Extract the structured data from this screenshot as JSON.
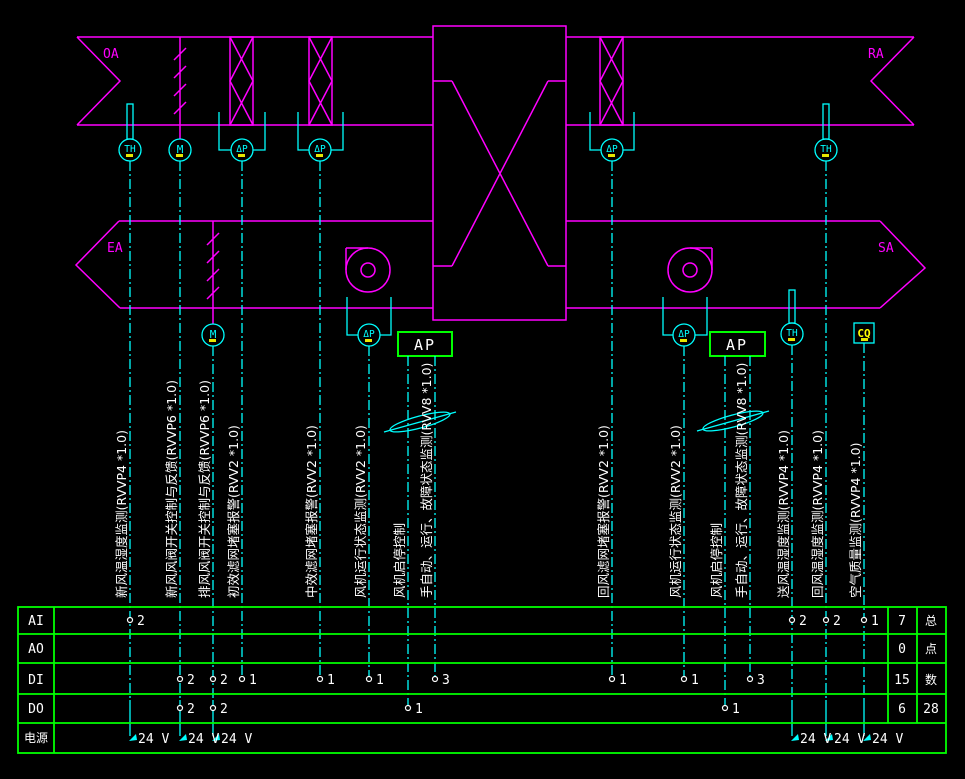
{
  "colors": {
    "duct_line": "#ff00ff",
    "signal_line": "#00ffff",
    "table_line": "#00ff00",
    "text": "#ffffff",
    "tag_text": "#ffff00",
    "background": "#000000"
  },
  "duct_labels": {
    "oa": "OA",
    "ra": "RA",
    "ea": "EA",
    "sa": "SA"
  },
  "symbols": {
    "temp_humidity": "TH",
    "damper_actuator": "M",
    "diff_pressure": "ΔP",
    "controller": "AP",
    "air_quality": "CQ"
  },
  "cables": [
    "新风温湿度监测(RVVP4 *1.0)",
    "新风风阀开关控制与反馈(RVVP6 *1.0)",
    "排风风阀开关控制与反馈(RVVP6 *1.0)",
    "初效滤网堵塞报警(RVV2 *1.0)",
    "中效滤网堵塞报警(RVV2 *1.0)",
    "风机运行状态监测(RVV2 *1.0)",
    "风机启停控制",
    "手自动、运行、故障状态监测(RVV8 *1.0)",
    "回风滤网堵塞报警(RVV2 *1.0)",
    "风机运行状态监测(RVV2 *1.0)",
    "风机启停控制",
    "手自动、运行、故障状态监测(RVV8 *1.0)",
    "送风温湿度监测(RVVP4 *1.0)",
    "回风温湿度监测(RVVP4 *1.0)",
    "空气质量监测(RVVP4 *1.0)"
  ],
  "table": {
    "row_labels": [
      "AI",
      "AO",
      "DI",
      "DO",
      "电源"
    ],
    "totals": [
      "7",
      "0",
      "15",
      "6"
    ],
    "totals_header_chars": [
      "总",
      "点",
      "数"
    ],
    "grand_total": "28",
    "power_value": "24 V",
    "ai_counts": [
      "2",
      "2",
      "2",
      "1"
    ],
    "di_counts": [
      "2",
      "2",
      "1",
      "1",
      "1",
      "3",
      "1",
      "1",
      "3"
    ],
    "do_counts": [
      "2",
      "2",
      "1",
      "1"
    ]
  }
}
